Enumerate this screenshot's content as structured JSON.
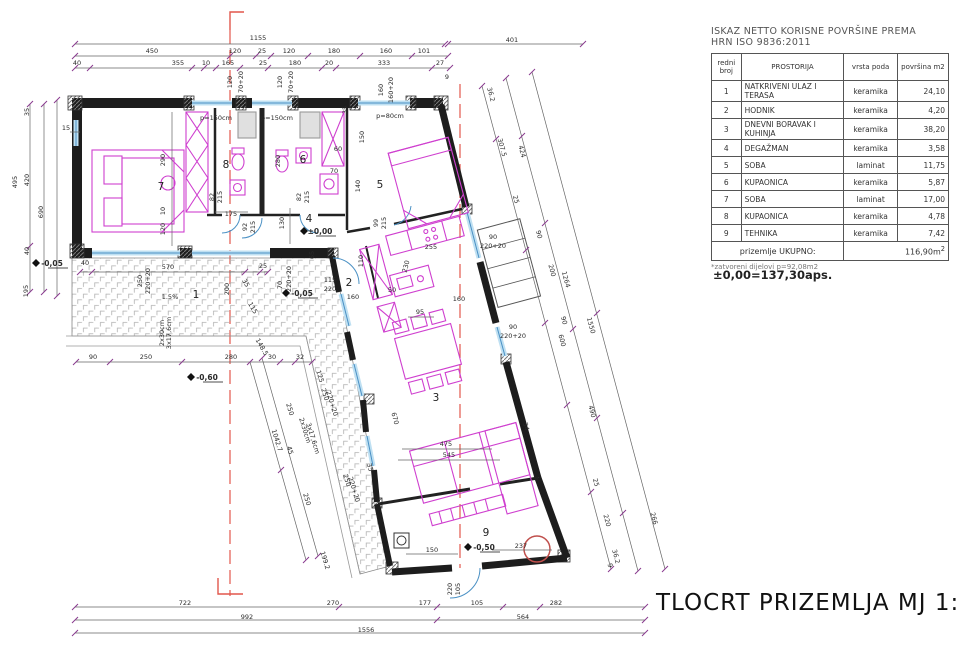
{
  "colors": {
    "furniture": "#cf3fcf",
    "window": "#4a90c4",
    "axis_red": "#e2574c",
    "tick_purple": "#8a3b8f",
    "wall": "#1d1d1d"
  },
  "area_table": {
    "title_line1": "ISKAZ NETTO KORISNE POVRŠINE PREMA",
    "title_line2": "HRN ISO 9836:2011",
    "headers": [
      "redni broj",
      "PROSTORIJA",
      "vrsta poda",
      "površina m2"
    ],
    "rows": [
      [
        "1",
        "NATKRIVENI ULAZ I TERASA",
        "keramika",
        "24,10"
      ],
      [
        "2",
        "HODNIK",
        "keramika",
        "4,20"
      ],
      [
        "3",
        "DNEVNI BORAVAK I KUHINJA",
        "keramika",
        "38,20"
      ],
      [
        "4",
        "DEGAŽMAN",
        "keramika",
        "3,58"
      ],
      [
        "5",
        "SOBA",
        "laminat",
        "11,75"
      ],
      [
        "6",
        "KUPAONICA",
        "keramika",
        "5,87"
      ],
      [
        "7",
        "SOBA",
        "laminat",
        "17,00"
      ],
      [
        "8",
        "KUPAONICA",
        "keramika",
        "4,78"
      ],
      [
        "9",
        "TEHNIKA",
        "keramika",
        "7,42"
      ]
    ],
    "total_label": "prizemlje UKUPNO:",
    "total_value": "116,90m",
    "total_sup": "2",
    "footnote": "*zatvoreni dijelovi p=92,08m2"
  },
  "level_note": "±0,00=137,30aps.",
  "drawing_title": "TLOCRT PRIZEMLJA  MJ 1:100",
  "plan": {
    "room_numbers": [
      {
        "t": "1",
        "x": 196,
        "y": 298
      },
      {
        "t": "2",
        "x": 349,
        "y": 286
      },
      {
        "t": "3",
        "x": 436,
        "y": 401
      },
      {
        "t": "4",
        "x": 309,
        "y": 222
      },
      {
        "t": "5",
        "x": 380,
        "y": 188
      },
      {
        "t": "6",
        "x": 303,
        "y": 163
      },
      {
        "t": "7",
        "x": 161,
        "y": 190
      },
      {
        "t": "8",
        "x": 226,
        "y": 168
      },
      {
        "t": "9",
        "x": 486,
        "y": 536
      }
    ],
    "levels": [
      {
        "t": "±0,00",
        "x": 320,
        "y": 234
      },
      {
        "t": "-0,05",
        "x": 52,
        "y": 266
      },
      {
        "t": "-0,05",
        "x": 302,
        "y": 296
      },
      {
        "t": "-0,60",
        "x": 207,
        "y": 380
      },
      {
        "t": "-0,50",
        "x": 484,
        "y": 550
      }
    ],
    "windows": [
      {
        "t": "p=150cm",
        "x": 216,
        "y": 120
      },
      {
        "t": "p=150cm",
        "x": 277,
        "y": 120
      },
      {
        "t": "p=80cm",
        "x": 390,
        "y": 118
      }
    ],
    "dims": [
      {
        "t": "1155",
        "x": 258,
        "y": 40
      },
      {
        "t": "401",
        "x": 512,
        "y": 42
      },
      {
        "t": "450",
        "x": 152,
        "y": 53
      },
      {
        "t": "120",
        "x": 235,
        "y": 53
      },
      {
        "t": "25",
        "x": 262,
        "y": 53
      },
      {
        "t": "120",
        "x": 289,
        "y": 53
      },
      {
        "t": "180",
        "x": 334,
        "y": 53
      },
      {
        "t": "160",
        "x": 386,
        "y": 53
      },
      {
        "t": "101",
        "x": 424,
        "y": 53
      },
      {
        "t": "40",
        "x": 77,
        "y": 65
      },
      {
        "t": "355",
        "x": 178,
        "y": 65
      },
      {
        "t": "10",
        "x": 206,
        "y": 65
      },
      {
        "t": "165",
        "x": 228,
        "y": 65
      },
      {
        "t": "25",
        "x": 263,
        "y": 65
      },
      {
        "t": "180",
        "x": 295,
        "y": 65
      },
      {
        "t": "20",
        "x": 329,
        "y": 65
      },
      {
        "t": "333",
        "x": 384,
        "y": 65
      },
      {
        "t": "27",
        "x": 440,
        "y": 65
      },
      {
        "t": "9",
        "x": 447,
        "y": 79
      },
      {
        "t": "120",
        "x": 232,
        "y": 82,
        "r": -90
      },
      {
        "t": "70+20",
        "x": 243,
        "y": 82,
        "r": -90
      },
      {
        "t": "120",
        "x": 282,
        "y": 82,
        "r": -90
      },
      {
        "t": "70+20",
        "x": 293,
        "y": 82,
        "r": -90
      },
      {
        "t": "160",
        "x": 383,
        "y": 90,
        "r": -90
      },
      {
        "t": "160+20",
        "x": 393,
        "y": 90,
        "r": -90
      },
      {
        "t": "35",
        "x": 347,
        "y": 110,
        "r": -90
      },
      {
        "t": "15",
        "x": 66,
        "y": 130
      },
      {
        "t": "495",
        "x": 17,
        "y": 182,
        "r": -90
      },
      {
        "t": "35",
        "x": 29,
        "y": 112,
        "r": -90
      },
      {
        "t": "420",
        "x": 29,
        "y": 180,
        "r": -90
      },
      {
        "t": "40",
        "x": 29,
        "y": 251,
        "r": -90
      },
      {
        "t": "195",
        "x": 28,
        "y": 291,
        "r": -90
      },
      {
        "t": "690",
        "x": 43,
        "y": 212,
        "r": -90
      },
      {
        "t": "722",
        "x": 185,
        "y": 605
      },
      {
        "t": "270",
        "x": 333,
        "y": 605
      },
      {
        "t": "177",
        "x": 425,
        "y": 605
      },
      {
        "t": "105",
        "x": 477,
        "y": 605
      },
      {
        "t": "282",
        "x": 556,
        "y": 605
      },
      {
        "t": "992",
        "x": 247,
        "y": 619
      },
      {
        "t": "564",
        "x": 523,
        "y": 619
      },
      {
        "t": "1556",
        "x": 366,
        "y": 632
      },
      {
        "t": "36.2",
        "x": 489,
        "y": 95,
        "r": 75
      },
      {
        "t": "307.5",
        "x": 500,
        "y": 148,
        "r": 75
      },
      {
        "t": "424",
        "x": 520,
        "y": 152,
        "r": 75
      },
      {
        "t": "25",
        "x": 514,
        "y": 200,
        "r": 75
      },
      {
        "t": "90",
        "x": 537,
        "y": 235,
        "r": 75
      },
      {
        "t": "200",
        "x": 550,
        "y": 271,
        "r": 75
      },
      {
        "t": "1264",
        "x": 564,
        "y": 280,
        "r": 75
      },
      {
        "t": "90",
        "x": 562,
        "y": 321,
        "r": 75
      },
      {
        "t": "600",
        "x": 560,
        "y": 341,
        "r": 75
      },
      {
        "t": "1550",
        "x": 589,
        "y": 326,
        "r": 75
      },
      {
        "t": "490",
        "x": 590,
        "y": 412,
        "r": 75
      },
      {
        "t": "25",
        "x": 594,
        "y": 483,
        "r": 75
      },
      {
        "t": "220",
        "x": 605,
        "y": 521,
        "r": 75
      },
      {
        "t": "266",
        "x": 652,
        "y": 519,
        "r": 75
      },
      {
        "t": "36.2",
        "x": 614,
        "y": 557,
        "r": 75
      },
      {
        "t": "9",
        "x": 608,
        "y": 566,
        "r": 75
      },
      {
        "t": "250",
        "x": 288,
        "y": 410,
        "r": 73
      },
      {
        "t": "1042.7",
        "x": 275,
        "y": 441,
        "r": 73
      },
      {
        "t": "45",
        "x": 288,
        "y": 451,
        "r": 73
      },
      {
        "t": "250",
        "x": 305,
        "y": 500,
        "r": 73
      },
      {
        "t": "199.2",
        "x": 323,
        "y": 561,
        "r": 73
      },
      {
        "t": "125",
        "x": 318,
        "y": 377,
        "r": 73
      },
      {
        "t": "250",
        "x": 323,
        "y": 395,
        "r": 73
      },
      {
        "t": "220+20",
        "x": 330,
        "y": 404,
        "r": 73,
        "s": 6
      },
      {
        "t": "2x30cm",
        "x": 303,
        "y": 431,
        "r": 73,
        "s": 6
      },
      {
        "t": "3x17,6cm",
        "x": 311,
        "y": 439,
        "r": 73,
        "s": 6
      },
      {
        "t": "40",
        "x": 85,
        "y": 265
      },
      {
        "t": "570",
        "x": 168,
        "y": 269
      },
      {
        "t": "25",
        "x": 263,
        "y": 268
      },
      {
        "t": "250",
        "x": 142,
        "y": 281,
        "r": -90
      },
      {
        "t": "220+20",
        "x": 150,
        "y": 281,
        "r": -90,
        "s": 6
      },
      {
        "t": "200",
        "x": 229,
        "y": 289,
        "r": -90
      },
      {
        "t": "35",
        "x": 244,
        "y": 284,
        "r": 60
      },
      {
        "t": "115",
        "x": 251,
        "y": 309,
        "r": 60
      },
      {
        "t": "148.5",
        "x": 260,
        "y": 348,
        "r": 60
      },
      {
        "t": "70",
        "x": 282,
        "y": 285,
        "r": -90
      },
      {
        "t": "220+20",
        "x": 291,
        "y": 279,
        "r": -90,
        "s": 6
      },
      {
        "t": "1.5%",
        "x": 170,
        "y": 299,
        "s": 6
      },
      {
        "t": "90",
        "x": 93,
        "y": 359
      },
      {
        "t": "250",
        "x": 146,
        "y": 359
      },
      {
        "t": "280",
        "x": 231,
        "y": 359
      },
      {
        "t": "30",
        "x": 272,
        "y": 359
      },
      {
        "t": "32",
        "x": 300,
        "y": 359
      },
      {
        "t": "2x30cm",
        "x": 164,
        "y": 333,
        "r": -90,
        "s": 6
      },
      {
        "t": "3x17,6cm",
        "x": 171,
        "y": 333,
        "r": -90,
        "s": 6
      },
      {
        "t": "290",
        "x": 165,
        "y": 160,
        "r": -90
      },
      {
        "t": "10",
        "x": 165,
        "y": 211,
        "r": -90
      },
      {
        "t": "120",
        "x": 165,
        "y": 229,
        "r": -90
      },
      {
        "t": "175",
        "x": 231,
        "y": 216
      },
      {
        "t": "82",
        "x": 214,
        "y": 197,
        "r": -90
      },
      {
        "t": "215",
        "x": 222,
        "y": 197,
        "r": -90
      },
      {
        "t": "82",
        "x": 301,
        "y": 197,
        "r": -90
      },
      {
        "t": "215",
        "x": 309,
        "y": 197,
        "r": -90
      },
      {
        "t": "92",
        "x": 247,
        "y": 227,
        "r": -90
      },
      {
        "t": "215",
        "x": 255,
        "y": 227,
        "r": -90
      },
      {
        "t": "99",
        "x": 378,
        "y": 223,
        "r": -90
      },
      {
        "t": "215",
        "x": 386,
        "y": 223,
        "r": -90
      },
      {
        "t": "130",
        "x": 284,
        "y": 223,
        "r": -90
      },
      {
        "t": "280",
        "x": 280,
        "y": 161,
        "r": -90
      },
      {
        "t": "60",
        "x": 338,
        "y": 151
      },
      {
        "t": "70",
        "x": 334,
        "y": 173
      },
      {
        "t": "150",
        "x": 364,
        "y": 137,
        "r": -90
      },
      {
        "t": "140",
        "x": 360,
        "y": 186,
        "r": -90
      },
      {
        "t": "110",
        "x": 363,
        "y": 261,
        "r": -90
      },
      {
        "t": "65",
        "x": 314,
        "y": 255,
        "r": -90
      },
      {
        "t": "115",
        "x": 330,
        "y": 282
      },
      {
        "t": "220",
        "x": 330,
        "y": 291
      },
      {
        "t": "160",
        "x": 353,
        "y": 299
      },
      {
        "t": "255",
        "x": 431,
        "y": 249
      },
      {
        "t": "50",
        "x": 392,
        "y": 292
      },
      {
        "t": "230",
        "x": 408,
        "y": 267,
        "r": -75
      },
      {
        "t": "95",
        "x": 420,
        "y": 314
      },
      {
        "t": "160",
        "x": 459,
        "y": 301
      },
      {
        "t": "90",
        "x": 493,
        "y": 239
      },
      {
        "t": "220+20",
        "x": 493,
        "y": 248,
        "s": 6
      },
      {
        "t": "90",
        "x": 513,
        "y": 329
      },
      {
        "t": "220+20",
        "x": 513,
        "y": 338,
        "s": 6
      },
      {
        "t": "670",
        "x": 393,
        "y": 419,
        "r": 75
      },
      {
        "t": "475",
        "x": 446,
        "y": 446
      },
      {
        "t": "545",
        "x": 449,
        "y": 457
      },
      {
        "t": "250",
        "x": 345,
        "y": 481,
        "r": 73
      },
      {
        "t": "220+20",
        "x": 352,
        "y": 490,
        "r": 73,
        "s": 6
      },
      {
        "t": "35",
        "x": 368,
        "y": 468,
        "r": 73
      },
      {
        "t": "34",
        "x": 524,
        "y": 427,
        "r": 75
      },
      {
        "t": "150",
        "x": 432,
        "y": 552
      },
      {
        "t": "237",
        "x": 521,
        "y": 548
      },
      {
        "t": "220",
        "x": 452,
        "y": 589,
        "r": -90
      },
      {
        "t": "105",
        "x": 460,
        "y": 589,
        "r": -90
      }
    ]
  }
}
